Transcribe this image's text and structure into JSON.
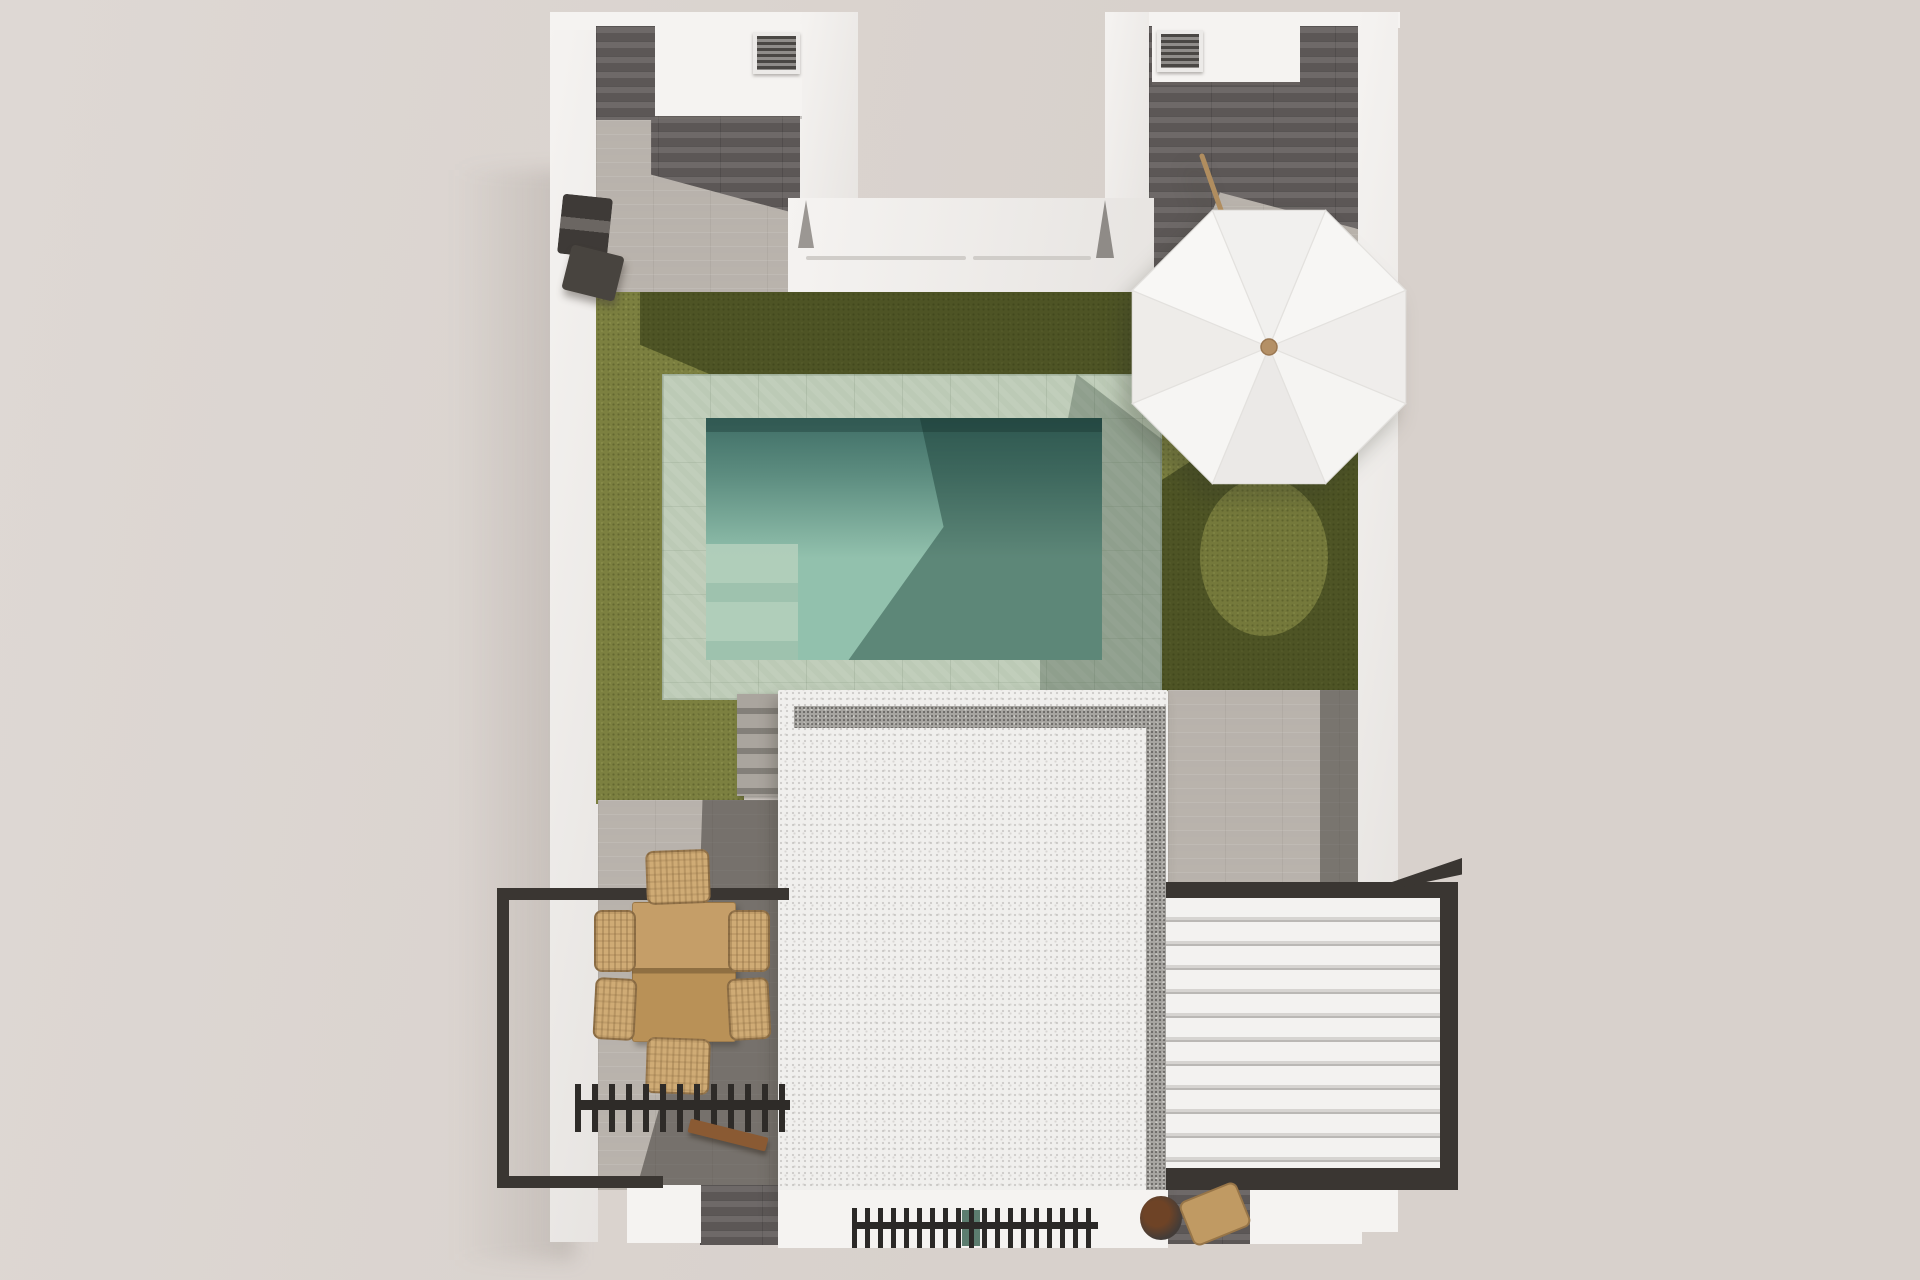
{
  "scene": {
    "type": "3d-architectural-render",
    "view": "top-down aerial",
    "description": "Bird's-eye 3D render of a villa plot: two upper wings with AC units, central lawn with rectangular pool and pale stone surround, white octagonal parasol, white speckled flat roof, left terrace with wooden dining set behind a dark railing, dark slatted pergola strips, and a white louvered bioclimatic pergola on the right."
  },
  "objects": {
    "plot-walls": "white perimeter walls",
    "left-courtyard": "upper-left patio with storage cabinet and air-conditioning unit",
    "right-courtyard": "upper-right patio with storage cabinet, air-conditioning unit and parasol pole",
    "terrace-notch": "white recessed terrace with sliding-door tracks",
    "bbq-unit": "dark outdoor kitchen unit against left wall",
    "lawn": "olive green artificial lawn",
    "pool": "rectangular swimming pool with pale green stone coping and entry steps",
    "parasol": "white octagonal parasol with wooden hub and pole",
    "roof-building": "white gravel-edged flat roof volume",
    "stairs": "grey garden steps beside the roof",
    "dining-set": "wooden table with six wicker chairs",
    "balcony-railing": "dark metal railing around left terrace",
    "slatted-pergola-left": "dark slatted pergola strip over left terrace",
    "louvered-pergola-right": "white louvered pergola with dark frame",
    "grill-vent": "dark slatted vent strip at bottom of building",
    "bench": "small wooden bench",
    "side-furniture": "wooden chair and dark planter at lower right"
  },
  "colors": {
    "bg": "#d8d1cc",
    "bgLight": "#ded8d4",
    "wall": "#f5f3f1",
    "wallShade": "#e7e4e1",
    "tileDark": "#666160",
    "tileLight": "#c2bcb5",
    "grass": "#7c8040",
    "grassShadow": "rgba(32,40,10,0.50)",
    "coping": "#bccab6",
    "waterDark": "#3f6e66",
    "waterLight": "#92c1ad",
    "roof": "#f0efed",
    "gravel": "#a7a5a1",
    "frame": "#3a3632",
    "louver": "#f3f2f0",
    "louverGap": "#bab8b5",
    "wood": "#c09a63",
    "wicker": "#cfab75",
    "bench": "#8a5a33",
    "bbq": "#3e3a37",
    "grill": "#2b2927",
    "stepsLight": "#aaa59e",
    "stepsDark": "#837f79",
    "hub": "#b49066",
    "pole": "#b08d5f",
    "track": "#d0cdc9",
    "teal": "#5c7d6f"
  }
}
